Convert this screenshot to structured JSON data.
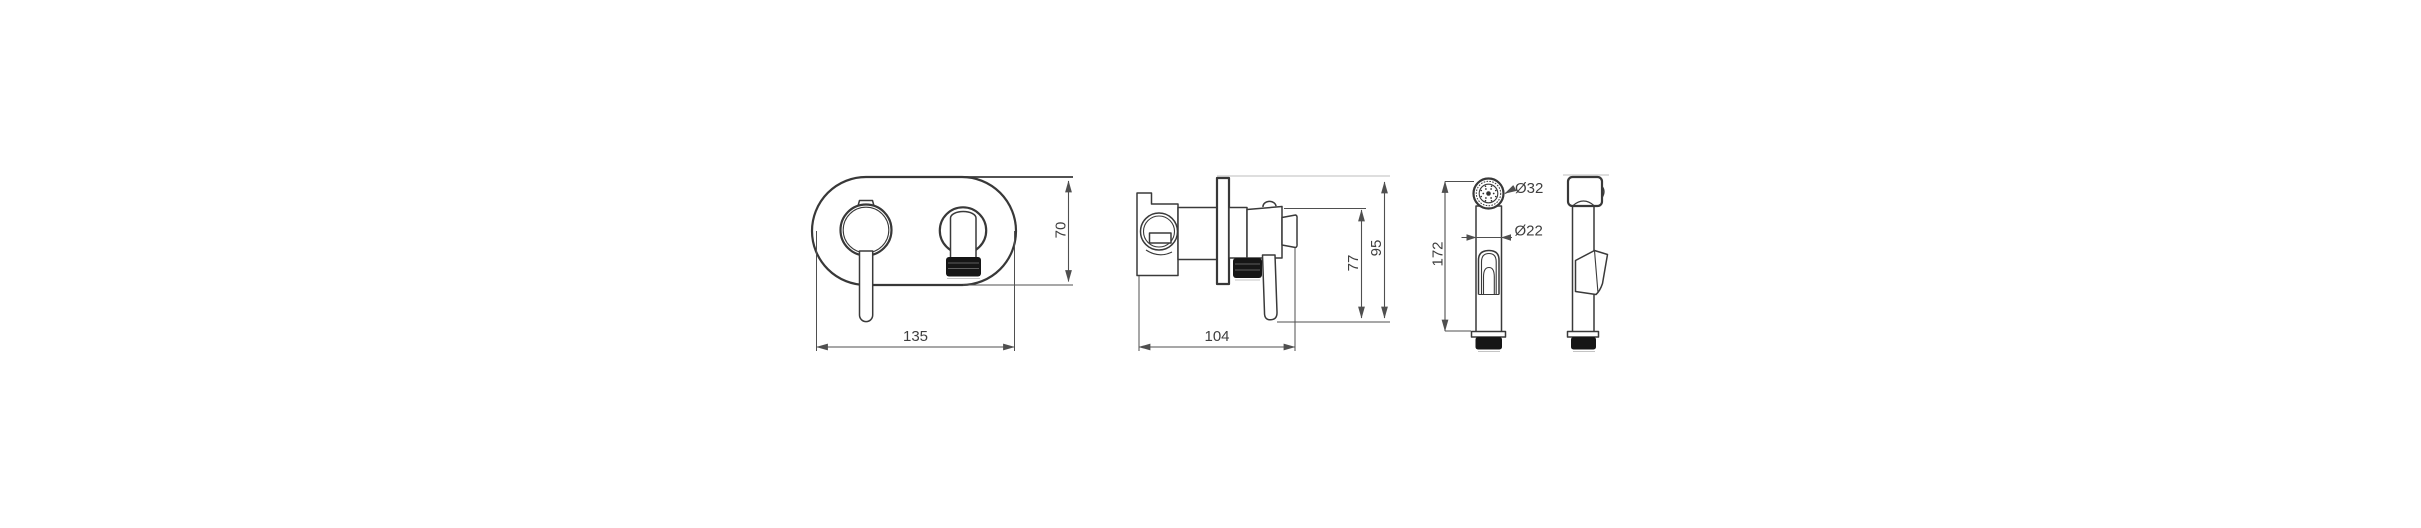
{
  "drawing": {
    "type": "technical-dimension-drawing",
    "subject": "concealed bidet mixer with hand shower",
    "trim_front_view": {
      "dims": {
        "plate_width": "135",
        "plate_height": "70"
      }
    },
    "trim_side_view": {
      "dims": {
        "depth": "104",
        "trim_height": "77",
        "overall_height": "95"
      }
    },
    "hand_shower": {
      "dims": {
        "height": "172",
        "head_diameter": "Ø32",
        "body_diameter": "Ø22"
      }
    },
    "colors": {
      "background": "#ffffff",
      "line": "#383838",
      "dimension_line": "#4f4f4f",
      "dimension_text": "#3f3f3f",
      "light_line": "#bdbdbd",
      "solid_black": "#161616"
    }
  }
}
